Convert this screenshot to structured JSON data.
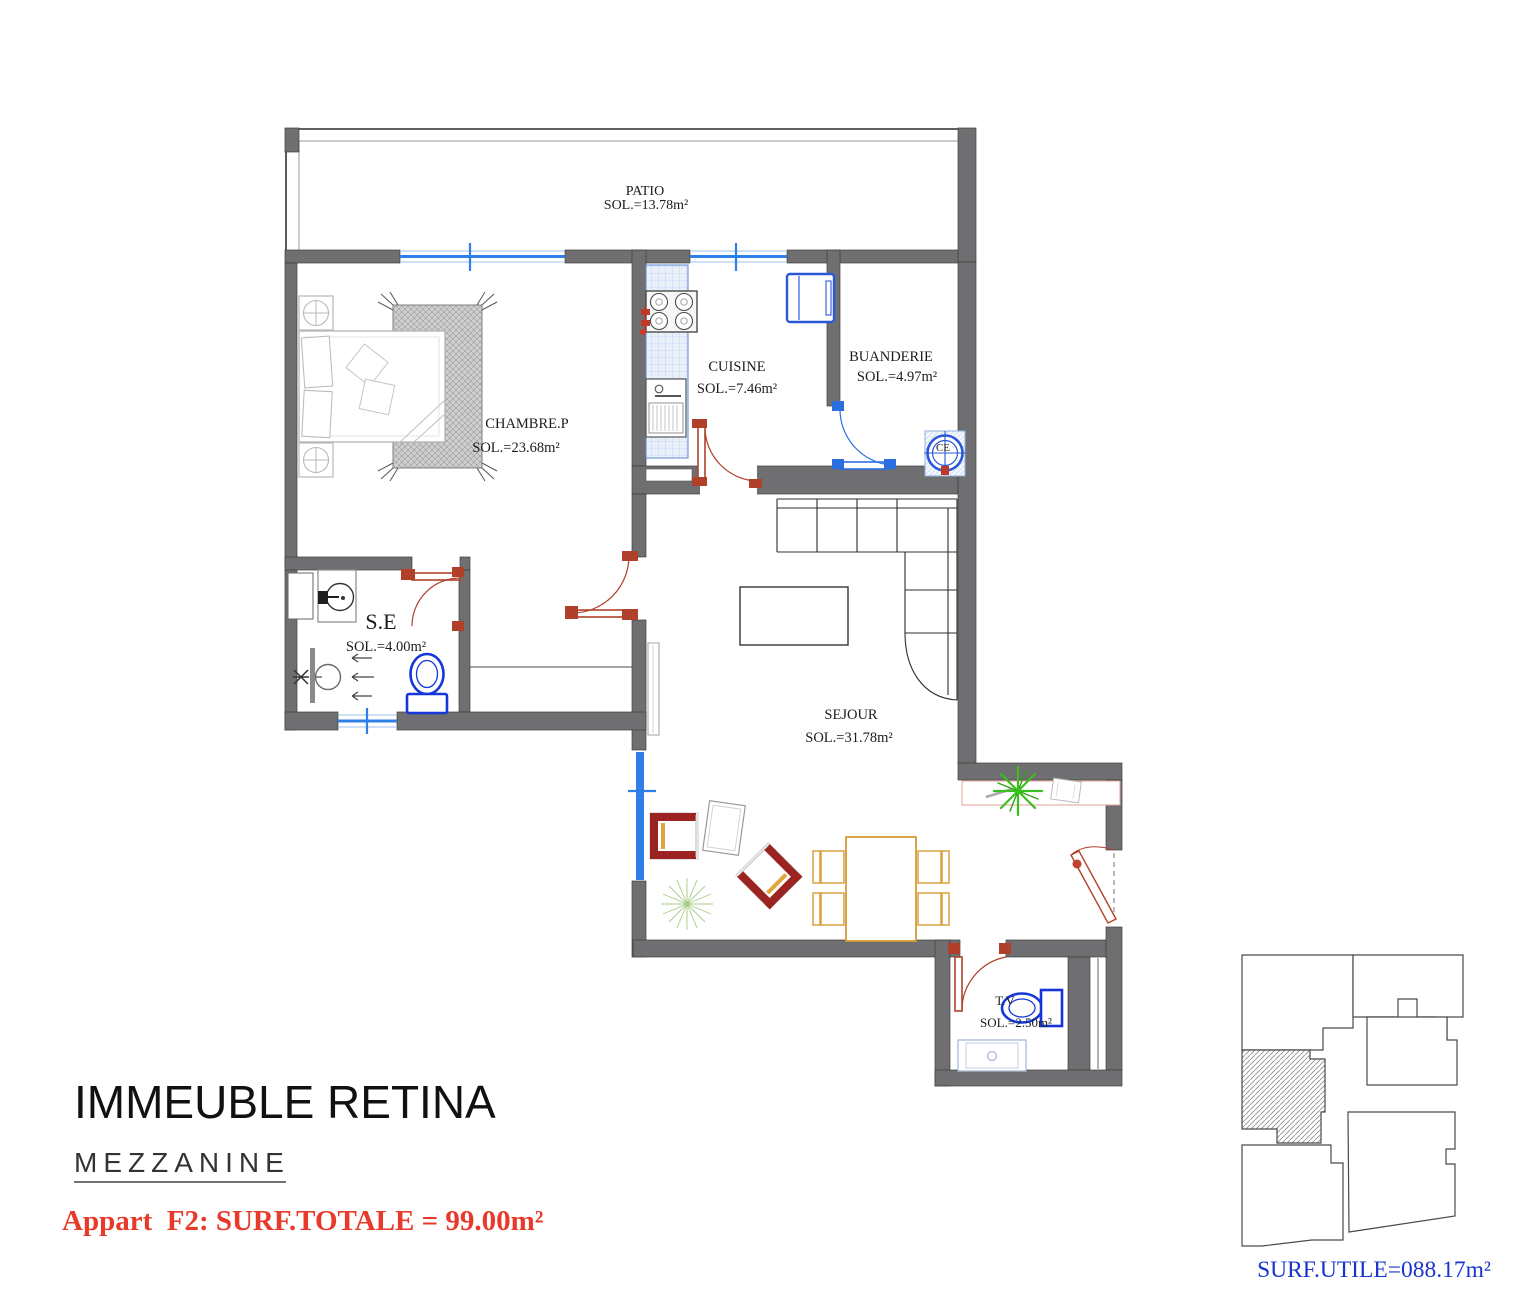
{
  "title_block": {
    "building_name": "IMMEUBLE RETINA",
    "level_name": "MEZZANINE",
    "apartment_info": "Appart  F2: SURF.TOTALE = 99.00m²"
  },
  "key_plan": {
    "caption": "SURF.UTILE=088.17m²"
  },
  "rooms": {
    "patio": {
      "name": "PATIO",
      "area": "SOL.=13.78m²"
    },
    "chambre": {
      "name": "CHAMBRE.P",
      "area": "SOL.=23.68m²"
    },
    "cuisine": {
      "name": "CUISINE",
      "area": "SOL.=7.46m²"
    },
    "buanderie": {
      "name": "BUANDERIE",
      "area": "SOL.=4.97m²"
    },
    "salle_eau": {
      "name": "S.E",
      "area": "SOL.=4.00m²"
    },
    "sejour": {
      "name": "SEJOUR",
      "area": "SOL.=31.78m²"
    },
    "tv": {
      "name": "T.V",
      "area": "SOL.=2.50m²"
    }
  },
  "equipment": {
    "water_heater_label": "CE"
  },
  "colors": {
    "wall": "#6f6f71",
    "door_red": "#b0402a",
    "window_blue": "#2f7fe8",
    "plumbing_blue": "#1636d9",
    "appliance_blue": "#2a58d8",
    "dining_orange": "#d79a34",
    "armchair_red": "#9c2420",
    "armchair_yellow": "#e0a63a",
    "plant_green": "#3bbf1e",
    "text_red": "#e8392a",
    "text_blue": "#1733cc"
  }
}
